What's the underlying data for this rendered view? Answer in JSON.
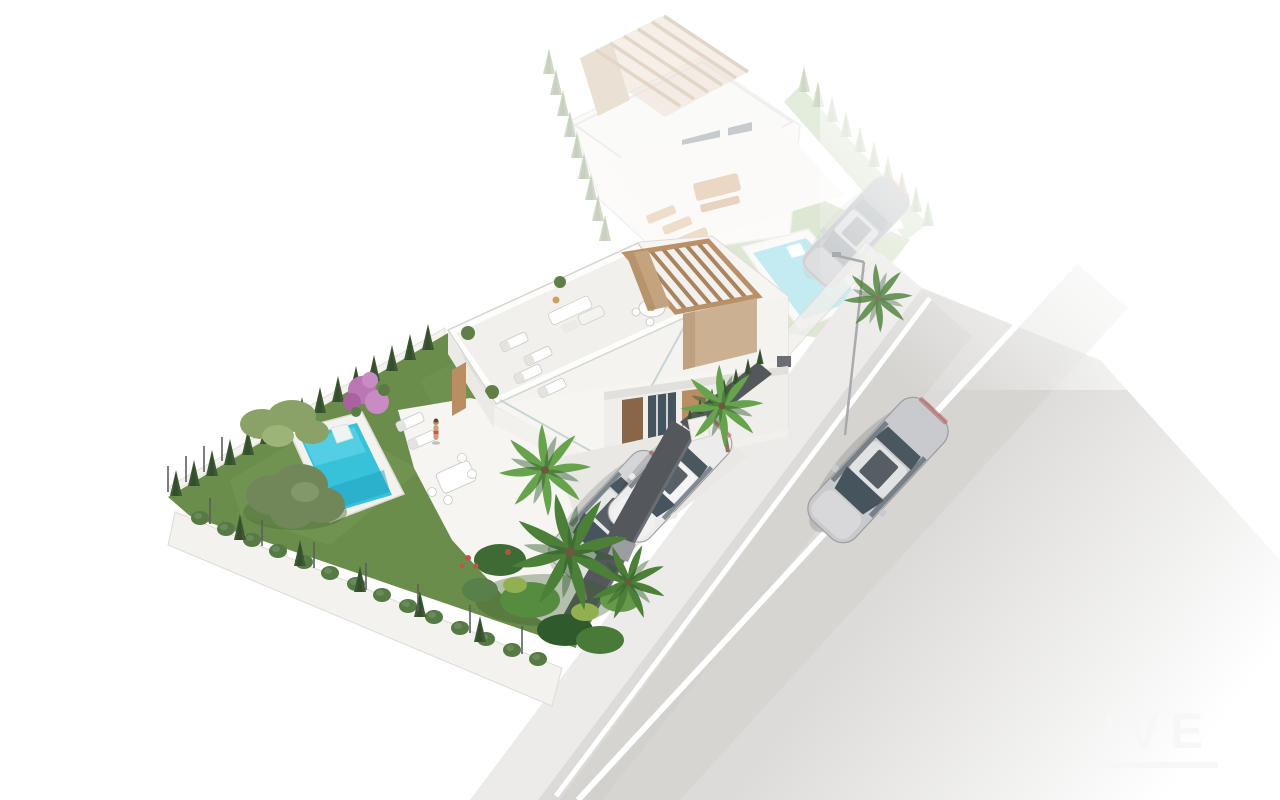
{
  "meta": {
    "type": "3d-architectural-rendering",
    "view": "aerial-isometric",
    "description": "Aerial 3D render of two modern white villas on a corner street. Foreground villa shown in full color with rooftop terrace, wooden pergola, turquoise private pool, lawn garden with olive tree, cypress hedges, palm trees and two parked cars behind a dark street fence. Background villa is ghosted/faded with its own pergola, terrace furniture and pool. A silver car drives on the road that fades to white."
  },
  "scene": {
    "foreground_property": {
      "label": "foreground villa plot",
      "features": [
        "modern white villa",
        "rooftop terrace with sun loungers and dining set",
        "wooden pergola",
        "private turquoise pool with roman steps",
        "green lawn",
        "cypress hedge perimeter",
        "olive tree",
        "bougainvillea",
        "palm trees and tropical plants",
        "white patio with dining table",
        "person standing on patio",
        "paved driveway",
        "two parked cars",
        "dark grey street fence with white pillars"
      ]
    },
    "background_property": {
      "label": "background villa plot (ghosted)",
      "features": [
        "white villa with slatted pergola",
        "rooftop terrace",
        "ground terrace with wooden outdoor furniture",
        "pale turquoise pool",
        "lawn",
        "perimeter hedges",
        "dark parked car",
        "small pool house"
      ]
    },
    "street": {
      "label": "street",
      "features": [
        "sidewalk along plot walls",
        "asphalt road fading to white",
        "white lane markings",
        "silver sedan driving",
        "street lamp"
      ]
    }
  },
  "watermark": {
    "text": "IVE"
  },
  "colors": {
    "lawn": "#6a8d4b",
    "lawnLight": "#86a763",
    "lawnGhost": "#9cb97c",
    "pool": "#38c2da",
    "poolDeep": "#1f9fc0",
    "poolLight": "#66d6e8",
    "poolGhost": "#4ec3d6",
    "deck": "#f3f2ee",
    "wallWhite": "#f6f5f2",
    "wallShade": "#e9e8e4",
    "facade": "#efeeea",
    "roofTop": "#f1f0ec",
    "wood": "#b98e63",
    "woodDark": "#8a6648",
    "tanWall": "#cbb091",
    "pergola": "#c4a47f",
    "fenceDark": "#54585c",
    "hedge": "#3d5a35",
    "hedgeLight": "#557a44",
    "olive": "#71875a",
    "oliveLight": "#8aa268",
    "palm": "#4c8038",
    "palmLight": "#67a24c",
    "bougainvillea": "#bb76b4",
    "road": "#dcdbd9",
    "roadDark": "#cfceca",
    "sidewalk": "#ecebe9",
    "laneLine": "#ffffff",
    "carSilver": "#c9cacd",
    "carWhite": "#ececec",
    "carParkedSilver": "#d4d5d7",
    "carGhost": "#74787c",
    "glass": "#46545e",
    "watermark": "#f7f7f7"
  }
}
